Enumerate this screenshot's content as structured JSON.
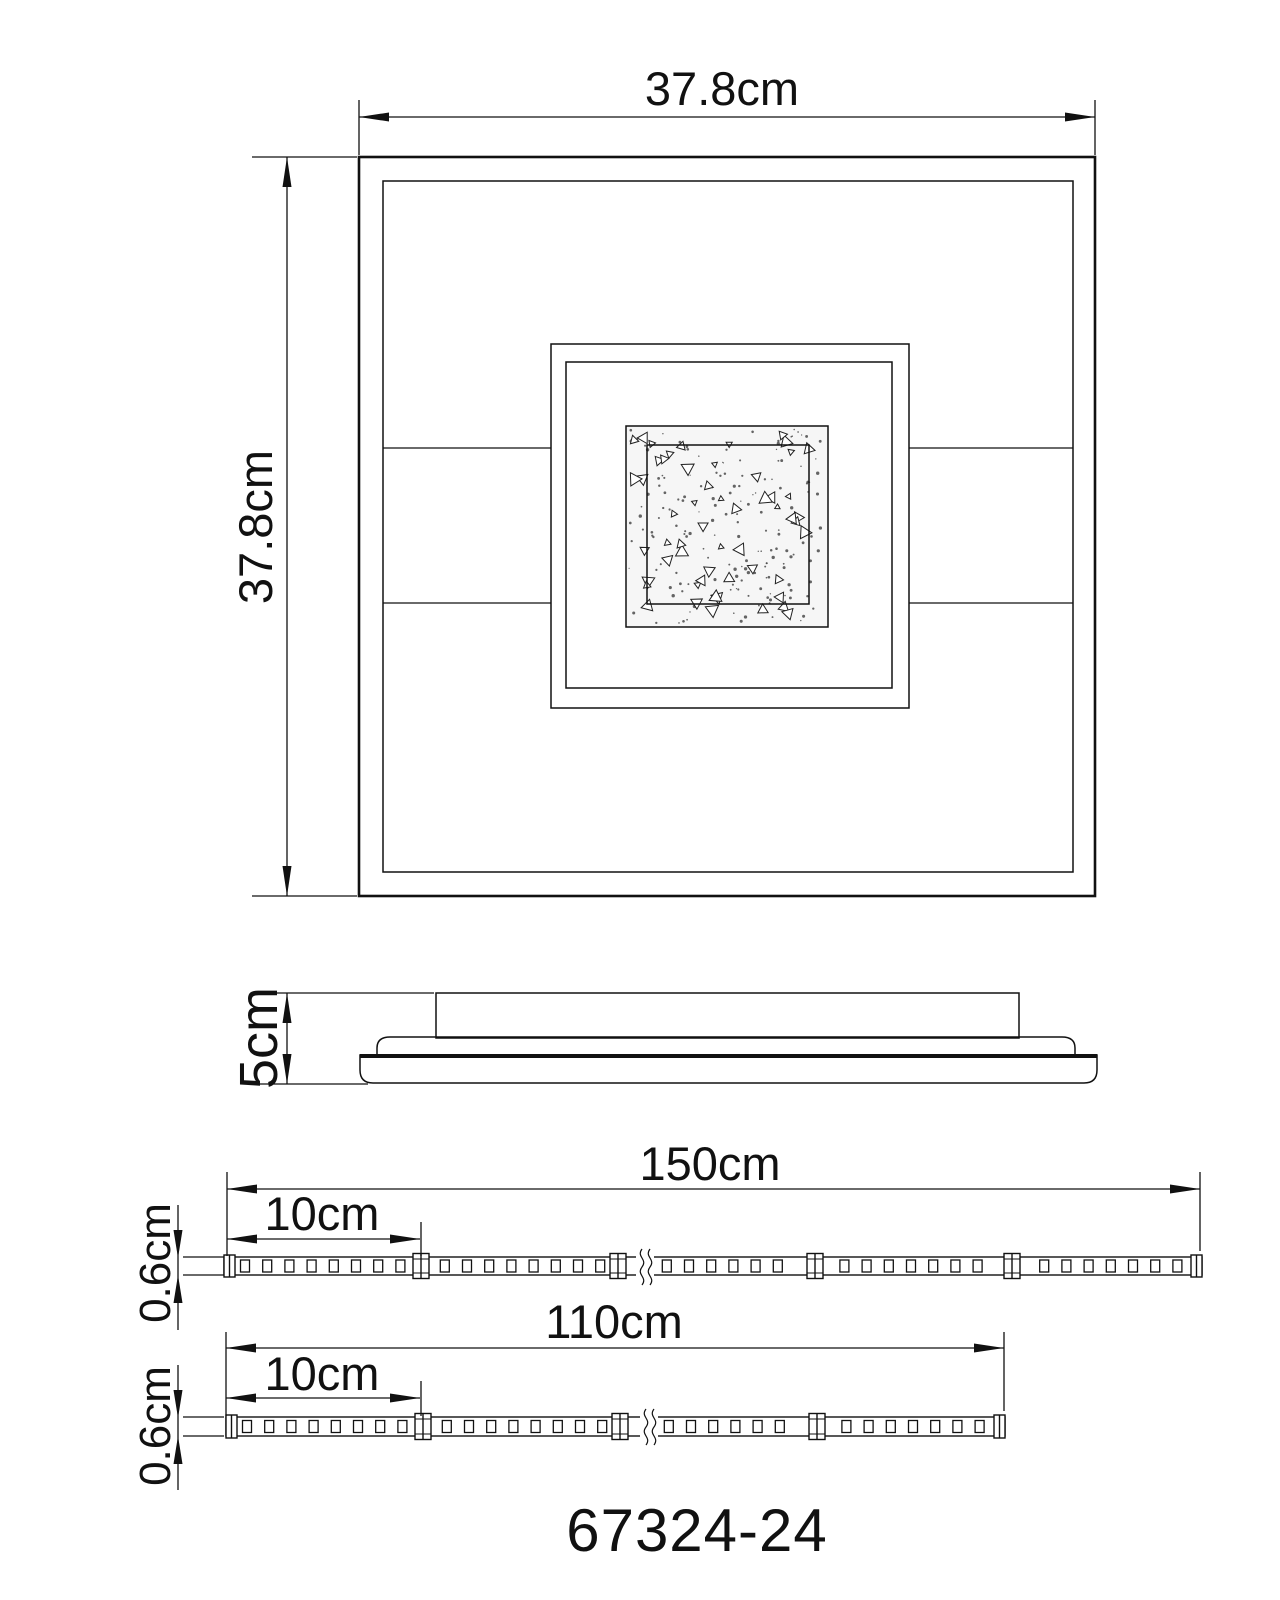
{
  "colors": {
    "line": "#111111",
    "background": "#ffffff",
    "speckle_bg": "#f5f5f5"
  },
  "top_view": {
    "width_label": "37.8cm",
    "height_label": "37.8cm"
  },
  "side_view": {
    "height_label": "5cm"
  },
  "strips": [
    {
      "length_label": "150cm",
      "segment_label": "10cm",
      "thickness_label": "0.6cm"
    },
    {
      "length_label": "110cm",
      "segment_label": "10cm",
      "thickness_label": "0.6cm"
    }
  ],
  "model_number": "67324-24"
}
